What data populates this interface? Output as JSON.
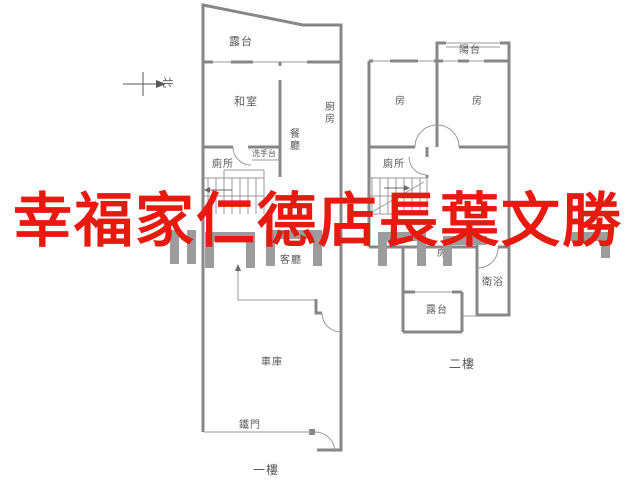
{
  "watermark": {
    "text": "幸福家仁德店長葉文勝",
    "color": "#e8190f"
  },
  "colors": {
    "wall": "#878787",
    "thin_line": "#9a9a9a",
    "label": "#5a5a5a"
  },
  "compass": {
    "label": "北"
  },
  "floor1": {
    "name": "一樓",
    "labels": {
      "terrace": "露台",
      "tatami": "和室",
      "kitchen": "廚房",
      "dining": "餐廳",
      "toilet": "廁所",
      "washbasin": "洗手台",
      "living": "客廳",
      "garage": "車庫",
      "gate": "鐵門"
    }
  },
  "floor2": {
    "name": "二樓",
    "labels": {
      "balcony": "陽台",
      "room_left": "房",
      "room_right": "房",
      "toilet": "廁所",
      "room_center": "房",
      "bath": "衛浴",
      "terrace": "露台"
    }
  }
}
